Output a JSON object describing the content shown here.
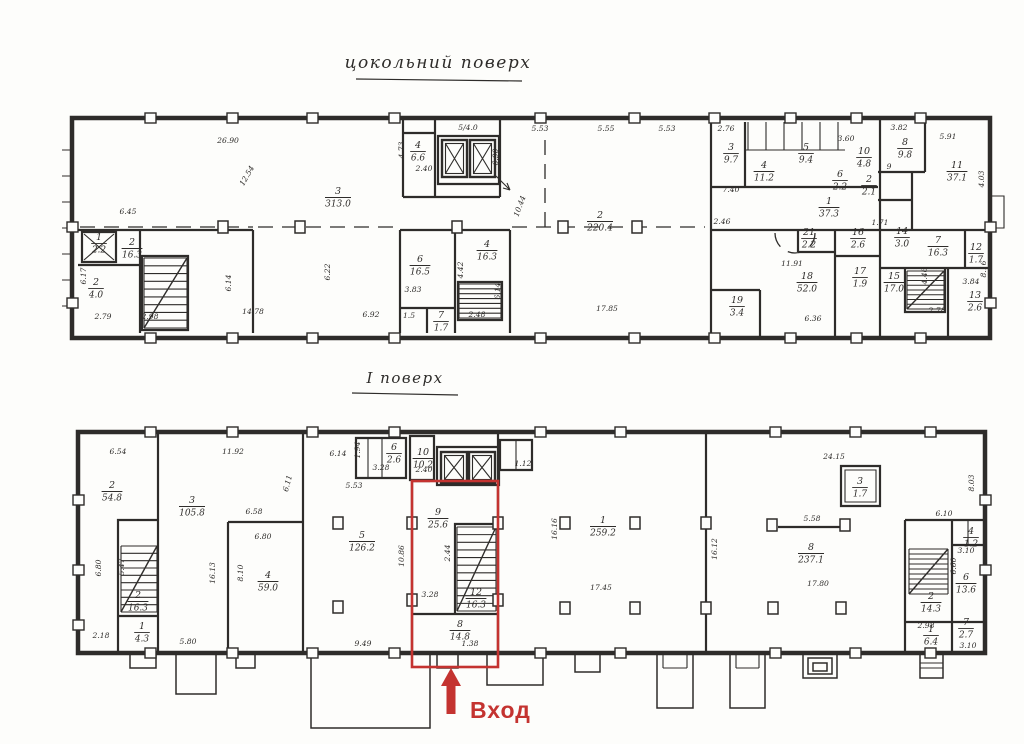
{
  "palette": {
    "ink": "#2e2c2a",
    "red": "#c43330",
    "paper": "#fdfdfb"
  },
  "titles": {
    "basement": "цокольний поверх",
    "first": "І поверх"
  },
  "entrance": {
    "label": "Вход"
  },
  "floors": {
    "basement": {
      "rooms": [
        {
          "n": "1",
          "a": "2.2",
          "x": 99,
          "y": 242
        },
        {
          "n": "2",
          "a": "4.0",
          "x": 96,
          "y": 287
        },
        {
          "n": "2",
          "a": "16.3",
          "x": 132,
          "y": 247
        },
        {
          "n": "3",
          "a": "313.0",
          "x": 338,
          "y": 196
        },
        {
          "n": "4",
          "a": "6.6",
          "x": 418,
          "y": 150
        },
        {
          "n": "6",
          "a": "16.5",
          "x": 420,
          "y": 264
        },
        {
          "n": "4",
          "a": "16.3",
          "x": 487,
          "y": 249
        },
        {
          "n": "7",
          "a": "1.7",
          "x": 441,
          "y": 320
        },
        {
          "n": "2",
          "a": "220.4",
          "x": 600,
          "y": 220
        },
        {
          "n": "3",
          "a": "9.7",
          "x": 731,
          "y": 152
        },
        {
          "n": "4",
          "a": "11.2",
          "x": 764,
          "y": 170
        },
        {
          "n": "5",
          "a": "9.4",
          "x": 806,
          "y": 152
        },
        {
          "n": "10",
          "a": "4.8",
          "x": 864,
          "y": 156
        },
        {
          "n": "6",
          "a": "2.2",
          "x": 840,
          "y": 179
        },
        {
          "n": "2",
          "a": "2.1",
          "x": 869,
          "y": 184
        },
        {
          "n": "8",
          "a": "9.8",
          "x": 905,
          "y": 147
        },
        {
          "n": "11",
          "a": "37.1",
          "x": 957,
          "y": 170
        },
        {
          "n": "1",
          "a": "37.3",
          "x": 829,
          "y": 206
        },
        {
          "n": "21",
          "a": "2.2",
          "x": 809,
          "y": 237
        },
        {
          "n": "16",
          "a": "2.6",
          "x": 858,
          "y": 237
        },
        {
          "n": "14",
          "a": "3.0",
          "x": 902,
          "y": 236
        },
        {
          "n": "7",
          "a": "16.3",
          "x": 938,
          "y": 245
        },
        {
          "n": "12",
          "a": "1.7",
          "x": 976,
          "y": 252
        },
        {
          "n": "18",
          "a": "52.0",
          "x": 807,
          "y": 281
        },
        {
          "n": "17",
          "a": "1.9",
          "x": 860,
          "y": 276
        },
        {
          "n": "15",
          "a": "17.0",
          "x": 894,
          "y": 281
        },
        {
          "n": "13",
          "a": "2.6",
          "x": 975,
          "y": 300
        },
        {
          "n": "19",
          "a": "3.4",
          "x": 737,
          "y": 305
        }
      ],
      "dims": [
        {
          "t": "26.90",
          "x": 228,
          "y": 143
        },
        {
          "t": "6.45",
          "x": 128,
          "y": 214
        },
        {
          "t": "2.79",
          "x": 103,
          "y": 319
        },
        {
          "t": "2.98",
          "x": 150,
          "y": 319
        },
        {
          "t": "14.78",
          "x": 253,
          "y": 314
        },
        {
          "t": "6.92",
          "x": 371,
          "y": 317
        },
        {
          "t": "17.85",
          "x": 607,
          "y": 311
        },
        {
          "t": "5/4.0",
          "x": 468,
          "y": 130
        },
        {
          "t": "2.40",
          "x": 424,
          "y": 171
        },
        {
          "t": "5.53",
          "x": 540,
          "y": 131
        },
        {
          "t": "5.55",
          "x": 606,
          "y": 131
        },
        {
          "t": "5.53",
          "x": 667,
          "y": 131
        },
        {
          "t": "2.76",
          "x": 726,
          "y": 131
        },
        {
          "t": "3.60",
          "x": 846,
          "y": 141
        },
        {
          "t": "3.82",
          "x": 899,
          "y": 130
        },
        {
          "t": "5.91",
          "x": 948,
          "y": 139
        },
        {
          "t": "7.40",
          "x": 731,
          "y": 192
        },
        {
          "t": "2.46",
          "x": 722,
          "y": 224
        },
        {
          "t": "1.71",
          "x": 880,
          "y": 225
        },
        {
          "t": "11.91",
          "x": 792,
          "y": 266
        },
        {
          "t": "6.36",
          "x": 813,
          "y": 321
        },
        {
          "t": "2.78",
          "x": 937,
          "y": 313
        },
        {
          "t": "3.84",
          "x": 971,
          "y": 284
        },
        {
          "t": "2.48",
          "x": 477,
          "y": 317
        },
        {
          "t": "1.5",
          "x": 409,
          "y": 318
        },
        {
          "t": "9",
          "x": 889,
          "y": 169
        },
        {
          "t": "3.83",
          "x": 413,
          "y": 292
        },
        {
          "t": "12.54",
          "x": 249,
          "y": 177,
          "r": -60
        },
        {
          "t": "6.17",
          "x": 86,
          "y": 276,
          "r": -90
        },
        {
          "t": "6.14",
          "x": 231,
          "y": 283,
          "r": -90
        },
        {
          "t": "6.22",
          "x": 330,
          "y": 272,
          "r": -90
        },
        {
          "t": "4.73",
          "x": 404,
          "y": 150,
          "r": -90
        },
        {
          "t": "6.90",
          "x": 498,
          "y": 157,
          "r": -90
        },
        {
          "t": "10.44",
          "x": 522,
          "y": 207,
          "r": -70
        },
        {
          "t": "4.42",
          "x": 463,
          "y": 270,
          "r": -90
        },
        {
          "t": "6.14",
          "x": 500,
          "y": 291,
          "r": -90
        },
        {
          "t": "4.03",
          "x": 984,
          "y": 179,
          "r": -90
        },
        {
          "t": "4.46",
          "x": 927,
          "y": 276,
          "r": -90
        },
        {
          "t": "8.16",
          "x": 986,
          "y": 269,
          "r": -90
        }
      ]
    },
    "first": {
      "rooms": [
        {
          "n": "2",
          "a": "54.8",
          "x": 112,
          "y": 490
        },
        {
          "n": "3",
          "a": "105.8",
          "x": 192,
          "y": 505
        },
        {
          "n": "4",
          "a": "59.0",
          "x": 268,
          "y": 580
        },
        {
          "n": "2",
          "a": "16.3",
          "x": 138,
          "y": 600
        },
        {
          "n": "1",
          "a": "4.3",
          "x": 142,
          "y": 631
        },
        {
          "n": "5",
          "a": "126.2",
          "x": 362,
          "y": 540
        },
        {
          "n": "6",
          "a": "2.6",
          "x": 394,
          "y": 452
        },
        {
          "n": "10",
          "a": "10.2",
          "x": 423,
          "y": 457
        },
        {
          "n": "9",
          "a": "25.6",
          "x": 438,
          "y": 517
        },
        {
          "n": "12",
          "a": "16.3",
          "x": 476,
          "y": 597
        },
        {
          "n": "8",
          "a": "14.8",
          "x": 460,
          "y": 629
        },
        {
          "n": "1",
          "a": "259.2",
          "x": 603,
          "y": 525
        },
        {
          "n": "8",
          "a": "237.1",
          "x": 811,
          "y": 552
        },
        {
          "n": "3",
          "a": "1.7",
          "x": 860,
          "y": 486
        },
        {
          "n": "2",
          "a": "14.3",
          "x": 931,
          "y": 601
        },
        {
          "n": "6",
          "a": "13.6",
          "x": 966,
          "y": 582
        },
        {
          "n": "4",
          "a": "1.2",
          "x": 971,
          "y": 536
        },
        {
          "n": "1",
          "a": "6.4",
          "x": 931,
          "y": 634
        },
        {
          "n": "7",
          "a": "2.7",
          "x": 966,
          "y": 627
        }
      ],
      "dims": [
        {
          "t": "6.54",
          "x": 118,
          "y": 454
        },
        {
          "t": "11.92",
          "x": 233,
          "y": 454
        },
        {
          "t": "2.18",
          "x": 101,
          "y": 638
        },
        {
          "t": "5.80",
          "x": 188,
          "y": 644
        },
        {
          "t": "9.49",
          "x": 363,
          "y": 646
        },
        {
          "t": "5.53",
          "x": 354,
          "y": 488
        },
        {
          "t": "6.14",
          "x": 338,
          "y": 456
        },
        {
          "t": "3.28",
          "x": 381,
          "y": 470
        },
        {
          "t": "2.40",
          "x": 424,
          "y": 472
        },
        {
          "t": "1.12",
          "x": 523,
          "y": 466
        },
        {
          "t": "3.28",
          "x": 430,
          "y": 597
        },
        {
          "t": "1.38",
          "x": 470,
          "y": 646
        },
        {
          "t": "6.58",
          "x": 254,
          "y": 514
        },
        {
          "t": "6.80",
          "x": 263,
          "y": 539
        },
        {
          "t": "17.45",
          "x": 601,
          "y": 590
        },
        {
          "t": "24.15",
          "x": 834,
          "y": 459
        },
        {
          "t": "5.58",
          "x": 812,
          "y": 521
        },
        {
          "t": "17.80",
          "x": 818,
          "y": 586
        },
        {
          "t": "6.10",
          "x": 944,
          "y": 516
        },
        {
          "t": "3.10",
          "x": 966,
          "y": 553
        },
        {
          "t": "3.10",
          "x": 968,
          "y": 648
        },
        {
          "t": "2.98",
          "x": 926,
          "y": 628
        },
        {
          "t": "16.13",
          "x": 215,
          "y": 573,
          "r": -90
        },
        {
          "t": "8.10",
          "x": 243,
          "y": 573,
          "r": -90
        },
        {
          "t": "6.80",
          "x": 101,
          "y": 568,
          "r": -90
        },
        {
          "t": "5.47",
          "x": 124,
          "y": 567,
          "r": -90
        },
        {
          "t": "6.11",
          "x": 290,
          "y": 484,
          "r": -75
        },
        {
          "t": "1.94",
          "x": 360,
          "y": 450,
          "r": -90
        },
        {
          "t": "10.86",
          "x": 404,
          "y": 556,
          "r": -90
        },
        {
          "t": "2.44",
          "x": 450,
          "y": 553,
          "r": -90
        },
        {
          "t": "16.16",
          "x": 557,
          "y": 529,
          "r": -90
        },
        {
          "t": "16.12",
          "x": 717,
          "y": 549,
          "r": -90
        },
        {
          "t": "8.03",
          "x": 974,
          "y": 483,
          "r": -90
        },
        {
          "t": "6.60",
          "x": 956,
          "y": 566,
          "r": -90
        }
      ]
    }
  }
}
